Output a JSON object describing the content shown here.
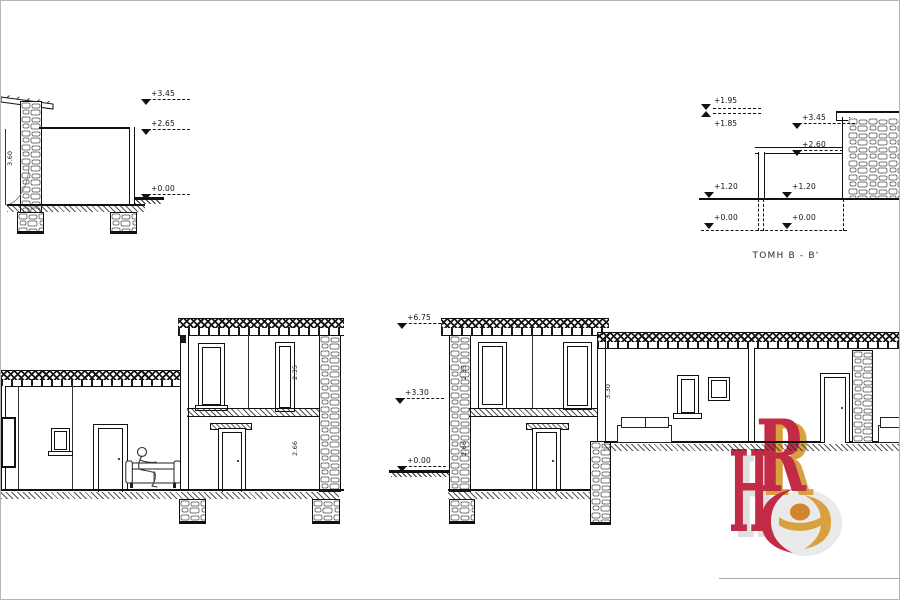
{
  "drawing": {
    "section_label": "ΤΟΜΗ Β - Β'",
    "elevations": {
      "tl_roof": "+3.45",
      "tl_ceiling": "+2.65",
      "tl_ground": "+0.00",
      "tr_top_upper": "+1.95",
      "tr_top_lower": "+1.85",
      "tr_roof": "+3.45",
      "tr_pergola": "+2.60",
      "tr_terrace_left": "+1.20",
      "tr_terrace_right": "+1.20",
      "tr_ground_left": "+0.00",
      "tr_ground_right": "+0.00",
      "mid_roof": "+6.75",
      "mid_floor": "+3.30",
      "mid_ground": "+0.00"
    },
    "dimensions": {
      "tl_wall_height": "3.60",
      "bl_upper_height": "2.35",
      "bl_lower_height": "2.66",
      "br_upper_height": "2.35",
      "br_lower_height": "2.66",
      "br_wing_height": "3.30"
    },
    "logo": {
      "letter_h": "H",
      "letter_r": "R",
      "letter_e": "e",
      "color_crimson": "#C22B45",
      "color_gold": "#D7A13F",
      "color_orange": "#D2832E"
    }
  }
}
